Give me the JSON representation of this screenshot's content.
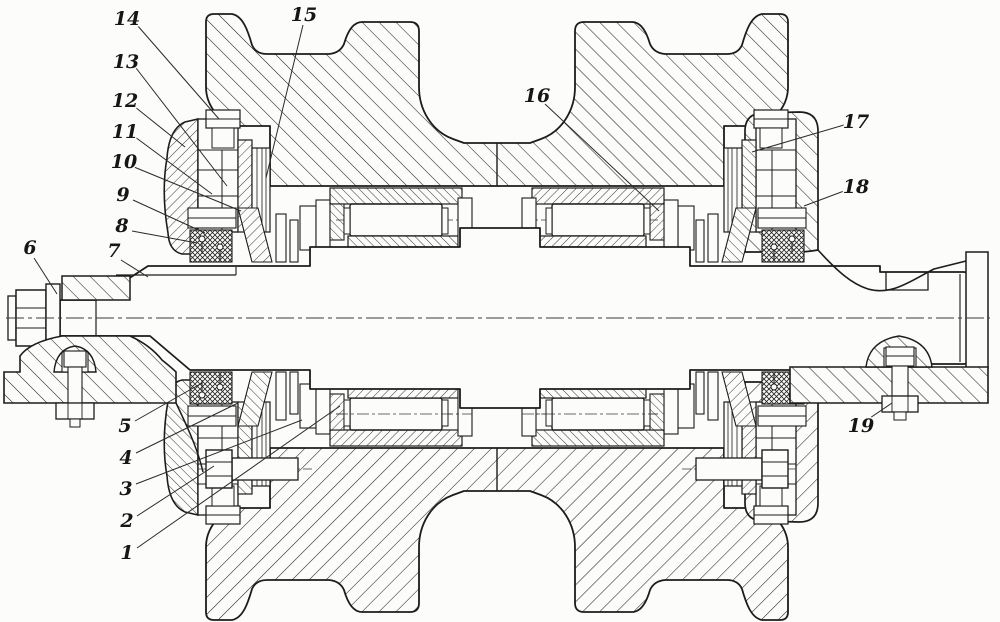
{
  "figure": {
    "type": "engineering-section-drawing",
    "description": "Longitudinal cross-section of a double-flanged track roller assembly on a stepped axle with roller bearings, seals, end caps and mounting brackets",
    "background_color": "#fcfcfa",
    "line_color": "#1c1c1c",
    "callout_style": "italic numerals with thin leader lines"
  },
  "callouts": [
    {
      "label": "1"
    },
    {
      "label": "2"
    },
    {
      "label": "3"
    },
    {
      "label": "4"
    },
    {
      "label": "5"
    },
    {
      "label": "6"
    },
    {
      "label": "7"
    },
    {
      "label": "8"
    },
    {
      "label": "9"
    },
    {
      "label": "10"
    },
    {
      "label": "11"
    },
    {
      "label": "12"
    },
    {
      "label": "13"
    },
    {
      "label": "14"
    },
    {
      "label": "15"
    },
    {
      "label": "16"
    },
    {
      "label": "17"
    },
    {
      "label": "18"
    },
    {
      "label": "19"
    }
  ]
}
